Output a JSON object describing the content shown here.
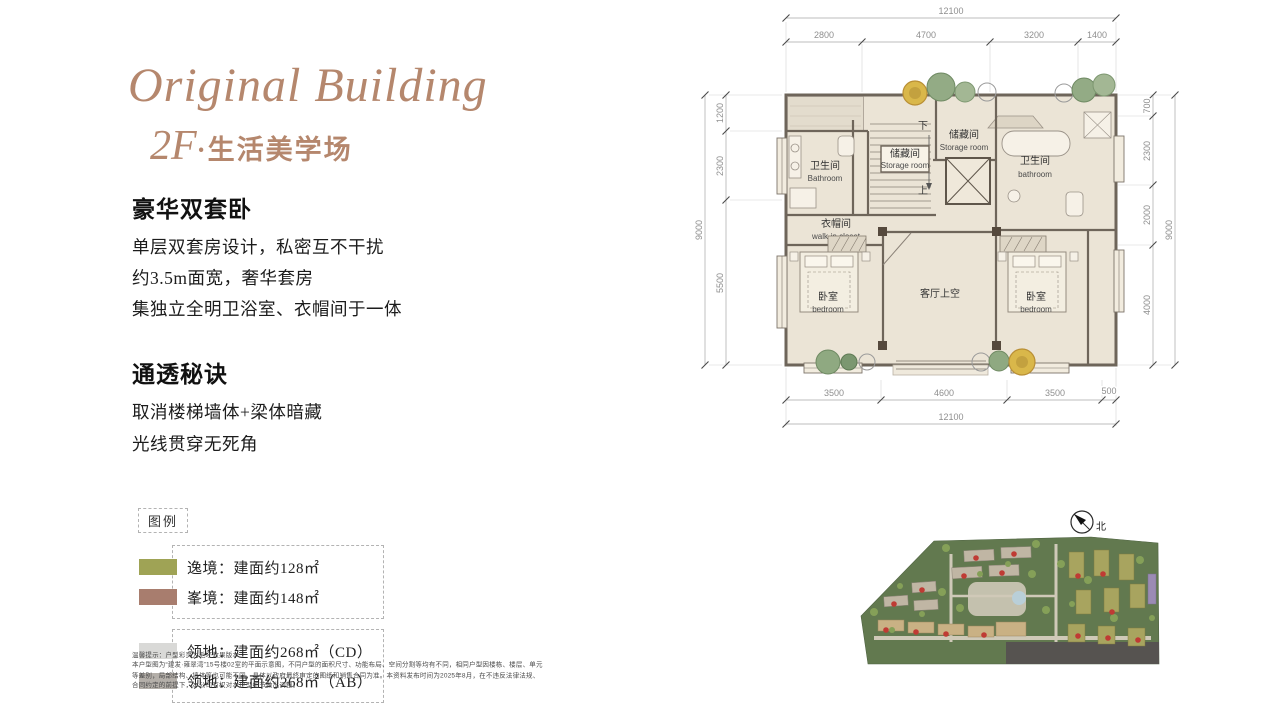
{
  "header": {
    "title": "Original Building",
    "subtitle_num": "2F",
    "subtitle_rest": "·生活美学场"
  },
  "sections": [
    {
      "heading": "豪华双套卧",
      "lines": [
        "单层双套房设计，私密互不干扰",
        "约3.5m面宽，奢华套房",
        "集独立全明卫浴室、衣帽间于一体"
      ]
    },
    {
      "heading": "通透秘诀",
      "lines": [
        "取消楼梯墙体+梁体暗藏",
        "光线贯穿无死角"
      ]
    }
  ],
  "legend": {
    "title": "图例",
    "groups": [
      {
        "items": [
          {
            "color": "#9fa355",
            "label": "逸境：建面约128㎡"
          },
          {
            "color": "#a87d6e",
            "label": "峯境：建面约148㎡"
          }
        ]
      },
      {
        "items": [
          {
            "color": "#d9d9d7",
            "label": "领地：建面约268㎡（CD）"
          },
          {
            "color": "#b4afa9",
            "label": "领地：建面约268㎡（AB）"
          }
        ]
      }
    ]
  },
  "disclaimer": [
    "温馨提示：户型彩页为毛坯效果版本",
    "本户型图为“建发·雍翠湾”15号楼02室的平面示意图，不同户型的面积尺寸、功能布局、空间分割等均有不同，相同户型因楼栋、楼层、单元",
    "等差别，局部结构、墙体等也可能不同，具体以政府最终审定的图纸和销售合同为准。本资料发布时间为2025年8月，在不违反法律法规、",
    "合同约定的前提下，本公司有权对本户型细节做出调整。"
  ],
  "floorplan": {
    "dims_top": {
      "overall": "12100",
      "segments": [
        "2800",
        "4700",
        "3200",
        "1400"
      ]
    },
    "dims_bottom": {
      "overall": "12100",
      "segments": [
        "3500",
        "4600",
        "3500",
        "500"
      ]
    },
    "dims_left": {
      "overall": "9000",
      "segments": [
        "1200",
        "2300",
        "5500"
      ]
    },
    "dims_right": {
      "overall": "9000",
      "segments": [
        "700",
        "2300",
        "2000",
        "4000"
      ]
    },
    "rooms": {
      "bathroom_left": {
        "cn": "卫生间",
        "en": "Bathroom"
      },
      "storage_stairs": {
        "cn": "储藏间",
        "en": "Storage room"
      },
      "storage_top": {
        "cn": "储藏间",
        "en": "Storage room"
      },
      "bathroom_right": {
        "cn": "卫生间",
        "en": "bathroom"
      },
      "closet": {
        "cn": "衣帽间",
        "en": "walk-in closet"
      },
      "bedroom_left": {
        "cn": "卧室",
        "en": "bedroom"
      },
      "living_void": {
        "cn": "客厅上空"
      },
      "bedroom_right": {
        "cn": "卧室",
        "en": "bedroom"
      },
      "stair_down": "下",
      "stair_up": "上"
    },
    "compass_label": "北"
  },
  "colors": {
    "accent_brown": "#b5876d",
    "floor_beige": "#ebe4d6",
    "wall": "#6e655a"
  }
}
